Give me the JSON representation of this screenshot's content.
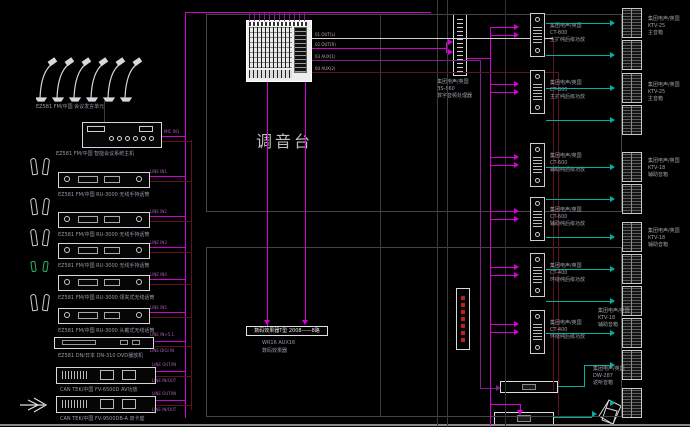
{
  "diagram": {
    "title": "调音台",
    "mixer_outputs": [
      "01 OUT(L)",
      "02 OUT(R)",
      "03 AUX(1)",
      "04 AUX(2)"
    ],
    "conference": {
      "mics_label": "EZ581 FM/中国  会议发言单元",
      "host_label": "EZ581 FM/中国  智能会议系统主机",
      "line_label": "MIC IN1"
    },
    "sources": [
      {
        "label": "EZ581 FM/中国  RU-3000  无线手持话筒",
        "lines": [
          "LINE IN1"
        ]
      },
      {
        "label": "EZ581 FM/中国  RU-3000  无线手持话筒",
        "lines": [
          "LINE IN2"
        ]
      },
      {
        "label": "EZ581 FM/中国  RU-3000  无线手持话筒",
        "lines": [
          "LINE IN3"
        ]
      },
      {
        "label": "EZ581 FM/中国  RU-3000  领夹式无线话筒",
        "lines": [
          "LINE IN4"
        ]
      },
      {
        "label": "EZ581 FM/中国  RU-3000  头戴式无线话筒",
        "lines": [
          "LINE IN5"
        ]
      },
      {
        "label": "EZ581 DN/日本  DN-310  DVD播放机",
        "lines": [
          "LINE IN+5.1",
          "LINE DIGI IN"
        ]
      },
      {
        "label": "CAN TEK/中国  FV-6500D  AV功放",
        "lines": [
          "LINE OUT/IN",
          "LINE IN/OUT"
        ]
      },
      {
        "label": "CAN TEK/中国  FV-9500DB-A  双卡座",
        "lines": [
          "LINE OUT/IN",
          "LINE IN/OUT"
        ]
      }
    ],
    "processor": {
      "label_lines": [
        "集团电声/英国",
        "BS-860",
        "数字音频处理器"
      ]
    },
    "effects": {
      "panel_text": "数码效果器T型 2008——8路",
      "label_lines": [
        "WR16 AUX16",
        "数码效果器"
      ]
    },
    "amplifiers": [
      {
        "label_lines": [
          "集团电声/英国",
          "CT-800",
          "主扩纯后级功放"
        ]
      },
      {
        "label_lines": [
          "集团电声/英国",
          "CT-800",
          "主扩纯后级功放"
        ]
      },
      {
        "label_lines": [
          "集团电声/英国",
          "CT-600",
          "辅助纯后级功放"
        ]
      },
      {
        "label_lines": [
          "集团电声/英国",
          "CT-600",
          "辅助纯后级功放"
        ]
      },
      {
        "label_lines": [
          "集团电声/英国",
          "CT-400",
          "环绕纯后级功放"
        ]
      },
      {
        "label_lines": [
          "集团电声/英国",
          "CT-400",
          "环绕纯后级功放"
        ]
      }
    ],
    "speaker_groups": [
      {
        "label_lines": [
          "集团电声/英国",
          "KTV-25",
          "主音箱"
        ]
      },
      {
        "label_lines": [
          "集团电声/英国",
          "KTV-25",
          "主音箱"
        ]
      },
      {
        "label_lines": [
          "集团电声/英国",
          "KTV-18",
          "辅助音箱"
        ]
      },
      {
        "label_lines": [
          "集团电声/英国",
          "KTV-18",
          "辅助音箱"
        ]
      },
      {
        "label_lines": [
          "集团电声/英国",
          "KTV-18",
          "辅助音箱"
        ]
      },
      {
        "label_lines": [
          "集团电声/英国",
          "DW-287",
          "返听音箱"
        ]
      }
    ],
    "colors": {
      "magenta": "#d400d4",
      "purple": "#7c2187",
      "maroon": "#5e141f",
      "cyan": "#00b0a4",
      "white_line": "#cfcfcf",
      "gray_line": "#3c3c3c",
      "green": "#27b45a",
      "red": "#bb2222"
    }
  }
}
